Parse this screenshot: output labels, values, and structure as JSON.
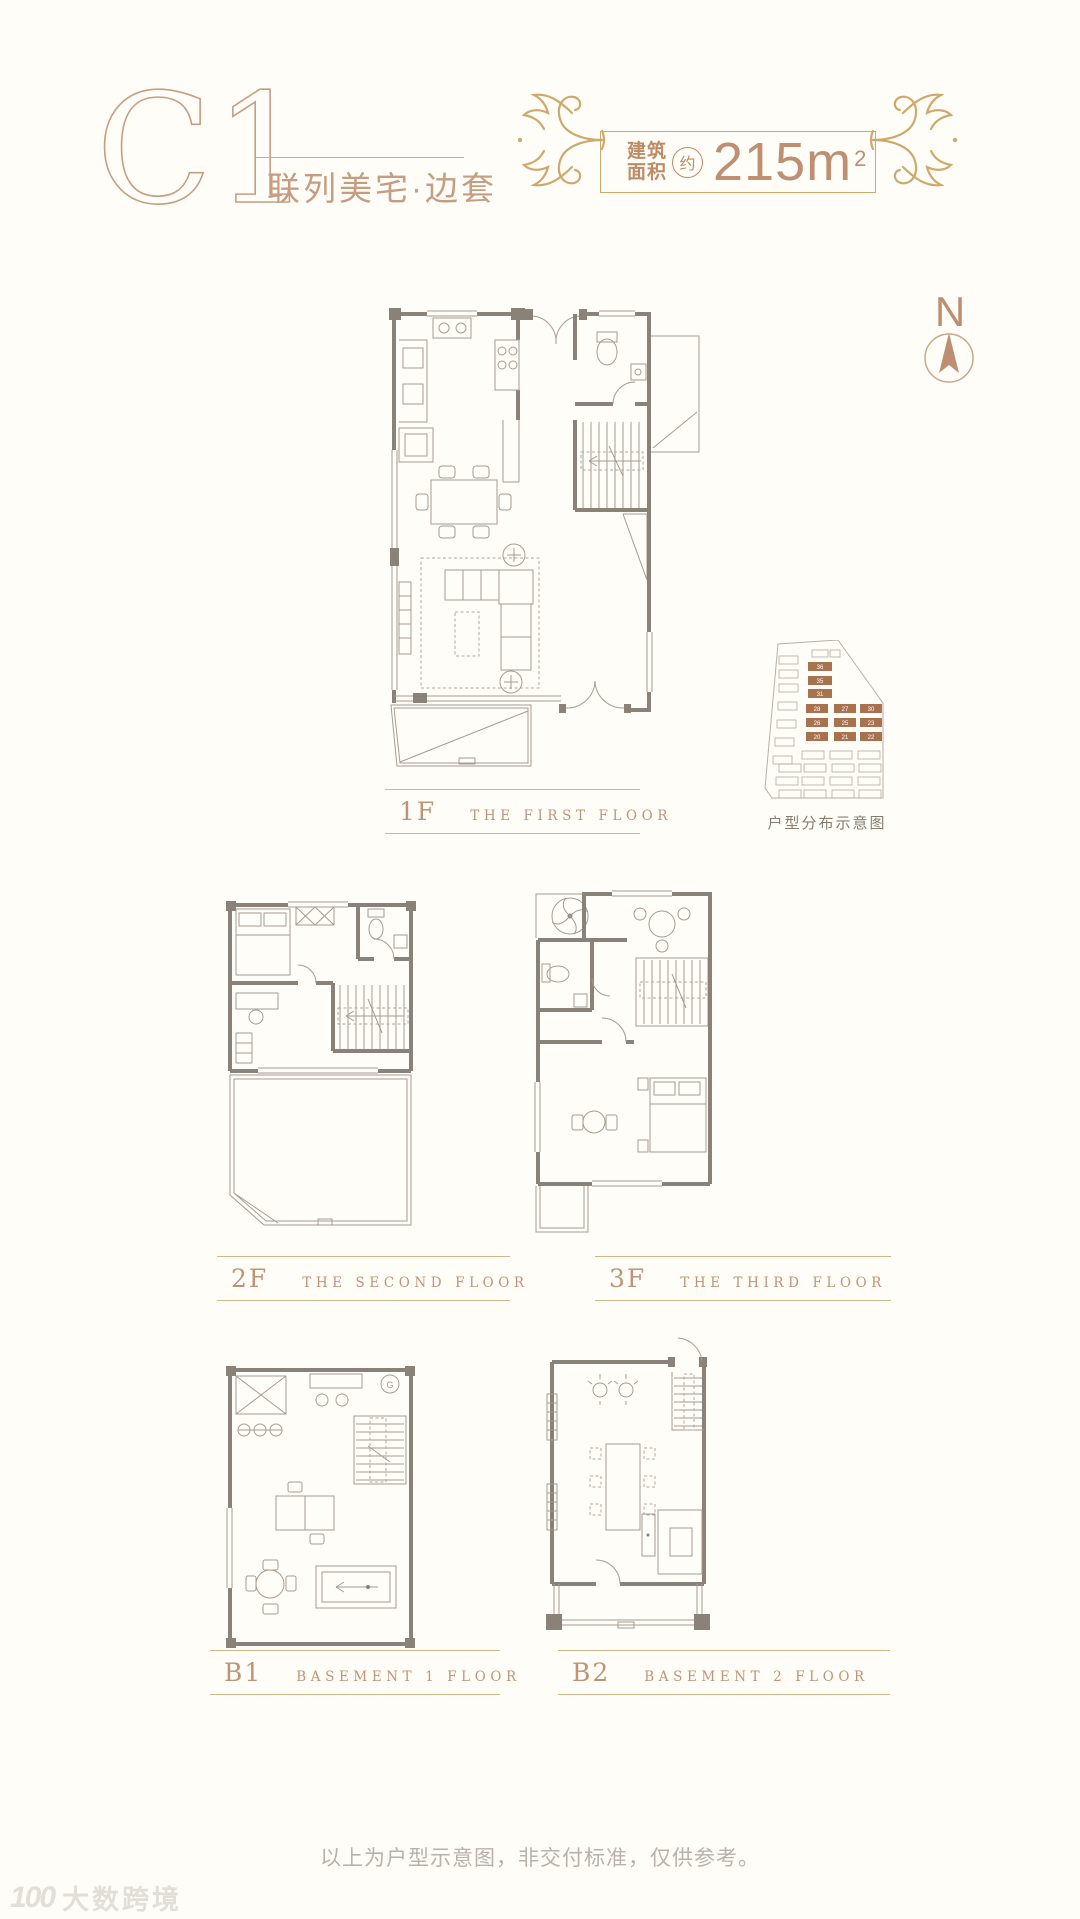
{
  "header": {
    "unit_code": "C1",
    "subtitle": "联列美宅·边套",
    "area_badge": {
      "label_line1": "建筑",
      "label_line2": "面积",
      "approx": "约",
      "value": "215m",
      "superscript": "2"
    }
  },
  "compass": {
    "label": "N"
  },
  "floors": [
    {
      "code": "1F",
      "name": "THE FIRST FLOOR"
    },
    {
      "code": "2F",
      "name": "THE SECOND FLOOR"
    },
    {
      "code": "3F",
      "name": "THE THIRD FLOOR"
    },
    {
      "code": "B1",
      "name": "BASEMENT 1 FLOOR"
    },
    {
      "code": "B2",
      "name": "BASEMENT 2 FLOOR"
    }
  ],
  "site_map": {
    "caption": "户型分布示意图",
    "highlighted_units": [
      "36",
      "35",
      "31",
      "28",
      "27",
      "30",
      "26",
      "25",
      "23",
      "20",
      "21",
      "22"
    ]
  },
  "plans": {
    "b1_marker": "G"
  },
  "page": {
    "disclaimer": "以上为户型示意图，非交付标准，仅供参考。",
    "watermark_text": "大数跨境",
    "watermark_logo": "100"
  },
  "colors": {
    "accent_gold": "#cfa96b",
    "accent_tan": "#c19376",
    "wall": "#8a8179",
    "furniture": "#a69c90",
    "site_highlight": "#a8724e",
    "disclaimer_text": "#b8b2a9"
  }
}
